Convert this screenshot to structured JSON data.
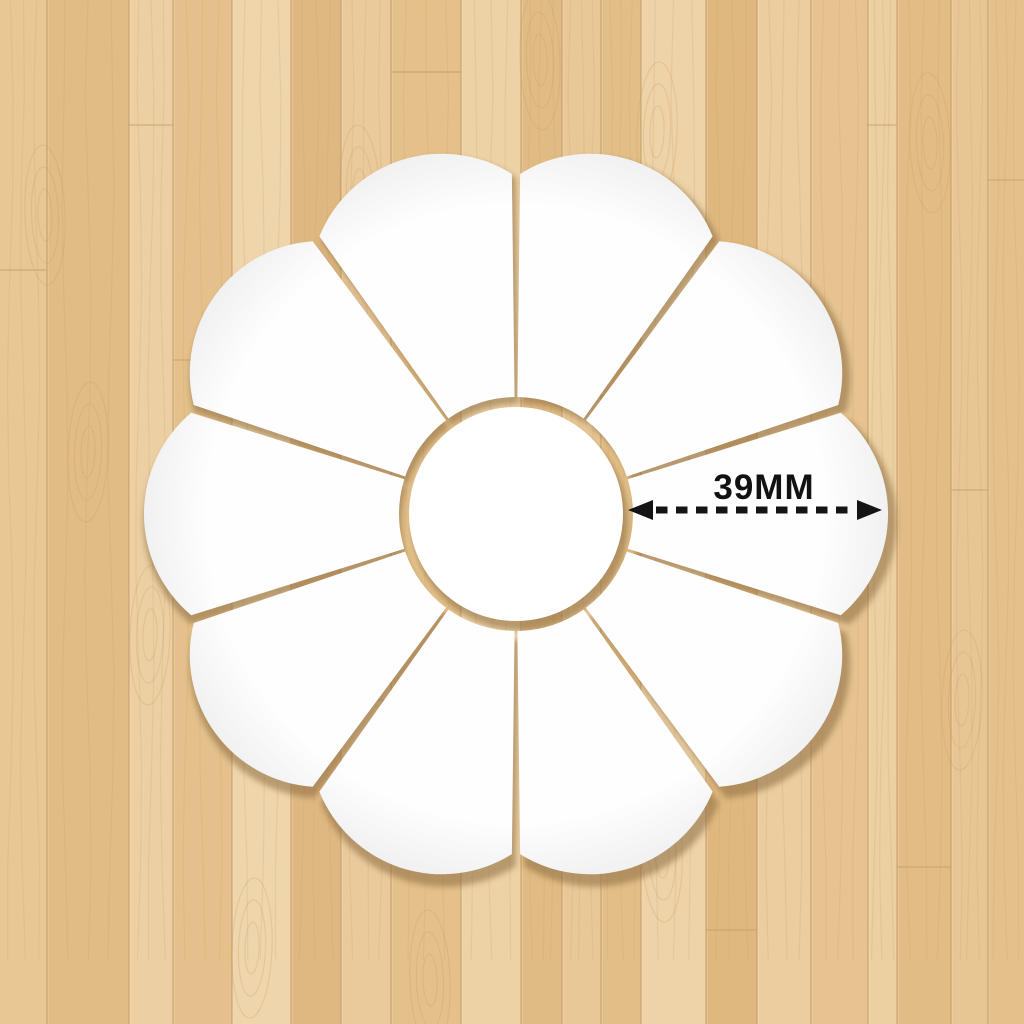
{
  "product_photo": {
    "subject": "flower-shaped mirror wall decal set laid on a wood floor",
    "annotation": {
      "label": "39MM",
      "arrow_color": "#141414",
      "style": "double-headed dashed arrow"
    },
    "flower": {
      "petal_count": 10,
      "piece_count": 11,
      "piece_color": "#ffffff",
      "shadow_color": "#8a6a3f"
    },
    "background": {
      "type": "wood-floor",
      "plank_palette": [
        "#e8c795",
        "#e1bc85",
        "#ecd0a3",
        "#e4c18c",
        "#efd5ab",
        "#dfb881",
        "#eaca9b",
        "#e4c08a",
        "#edd2a6",
        "#e1bb84",
        "#e9c897",
        "#e3bf88",
        "#eed3a8",
        "#dfb87f",
        "#ebcd9f",
        "#e6c390",
        "#ecd0a2",
        "#e2bc85",
        "#e8c694",
        "#e4c18b"
      ],
      "seam_color": "#c49b68",
      "seam_highlight_color": "#f2dcb2",
      "grain_color": "#c79e69"
    }
  }
}
